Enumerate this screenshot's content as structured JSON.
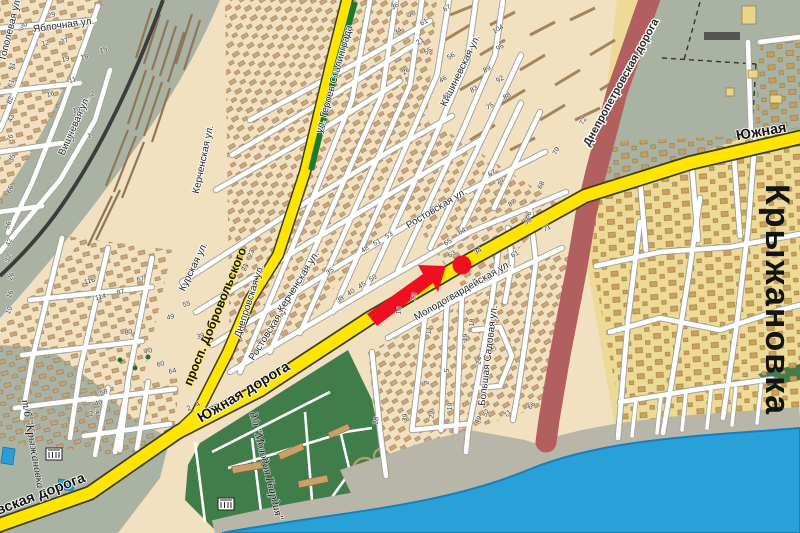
{
  "map": {
    "palette": {
      "land_west": "#f2e1c0",
      "land_east": "#ecda96",
      "rail_zone": "#aab3a3",
      "park_green": "#417c4b",
      "median_green": "#1f7a2d",
      "water_blue": "#2aa0d8",
      "beach_gray": "#b8b5a9",
      "road_yellow": "#ffe500",
      "road_red": "#b25f5f",
      "street_white": "#ffffff",
      "marker_red": "#ee1020",
      "building_tan": "#c9a478"
    },
    "marker": {
      "dot_x": 462,
      "dot_y": 265,
      "dot_r": 9.5,
      "arrow_tail_x": 372,
      "arrow_tail_y": 320,
      "arrow_tip_x": 446,
      "arrow_tip_y": 266
    },
    "street_labels": [
      {
        "t": "Южная дорога",
        "x": 246,
        "y": 396,
        "r": -31,
        "c": "road-lg"
      },
      {
        "t": "Южная",
        "x": 762,
        "y": 136,
        "r": -10,
        "c": "road-lg"
      },
      {
        "t": "Николаевская дорога",
        "x": 14,
        "y": 509,
        "r": -21,
        "c": "road-lg"
      },
      {
        "t": "просп. Добровольского",
        "x": 219,
        "y": 318,
        "r": -68,
        "c": "road"
      },
      {
        "t": "ул. Героев Сталинграда",
        "x": 337,
        "y": 80,
        "r": -74,
        "c": "street"
      },
      {
        "t": "Днепропетровская дорога",
        "x": 624,
        "y": 84,
        "r": -61,
        "c": "halo"
      },
      {
        "t": "Ростовская ул.",
        "x": 438,
        "y": 211,
        "r": -31,
        "c": "street"
      },
      {
        "t": "Ростовская ул.",
        "x": 272,
        "y": 332,
        "r": -58,
        "c": "street"
      },
      {
        "t": "Керченская ул.",
        "x": 301,
        "y": 283,
        "r": -58,
        "c": "street"
      },
      {
        "t": "Керченская ул.",
        "x": 206,
        "y": 160,
        "r": -78,
        "c": "street"
      },
      {
        "t": "Днепровская ул.",
        "x": 252,
        "y": 302,
        "r": -72,
        "c": "street"
      },
      {
        "t": "Курская ул.",
        "x": 196,
        "y": 268,
        "r": -64,
        "c": "street"
      },
      {
        "t": "Кишиневская ул.",
        "x": 463,
        "y": 72,
        "r": -64,
        "c": "street"
      },
      {
        "t": "Молодогвардейская ул.",
        "x": 464,
        "y": 293,
        "r": -30,
        "c": "street"
      },
      {
        "t": "Большая Садовая ул.",
        "x": 491,
        "y": 356,
        "r": -83,
        "c": "street"
      },
      {
        "t": "Вишневая ул.",
        "x": 77,
        "y": 127,
        "r": -66,
        "c": "street"
      },
      {
        "t": "Яблочная ул.",
        "x": 64,
        "y": 28,
        "r": -8,
        "c": "street"
      },
      {
        "t": "Тополевая ул.",
        "x": 13,
        "y": 30,
        "r": -76,
        "c": "street"
      },
      {
        "t": "Крыжановка",
        "x": 766,
        "y": 300,
        "r": 90,
        "c": "place-big"
      },
      {
        "t": "т/б \"Крыжановка\"",
        "x": 30,
        "y": 447,
        "r": 80,
        "c": "place-italic"
      },
      {
        "t": "д/л \"Молодая Гвардия\"",
        "x": 263,
        "y": 467,
        "r": 76,
        "c": "place-italic"
      }
    ],
    "house_numbers": [
      [
        "29",
        52,
        17,
        -15
      ],
      [
        "30",
        24,
        27,
        -15
      ],
      [
        "12",
        46,
        45,
        -15
      ],
      [
        "27",
        65,
        43,
        -15
      ],
      [
        "19",
        66,
        61,
        -15
      ],
      [
        "18",
        85,
        59,
        -15
      ],
      [
        "15",
        104,
        52,
        -15
      ],
      [
        "11",
        73,
        82,
        -15
      ],
      [
        "16",
        51,
        96,
        -15
      ],
      [
        "2",
        93,
        96,
        -15
      ],
      [
        "10",
        77,
        112,
        -15
      ],
      [
        "7",
        74,
        142,
        -15
      ],
      [
        "1",
        90,
        138,
        -15
      ],
      [
        "51",
        14,
        67,
        -70
      ],
      [
        "61",
        13,
        84,
        -70
      ],
      [
        "82",
        12,
        101,
        -70
      ],
      [
        "43",
        13,
        119,
        -70
      ],
      [
        "76",
        12,
        139,
        -70
      ],
      [
        "35",
        14,
        159,
        -70
      ],
      [
        "66",
        12,
        190,
        -70
      ],
      [
        "56",
        10,
        226,
        -70
      ],
      [
        "42",
        11,
        243,
        -70
      ],
      [
        "32",
        10,
        259,
        -70
      ],
      [
        "26",
        13,
        277,
        -70
      ],
      [
        "16",
        12,
        295,
        -70
      ],
      [
        "10",
        11,
        311,
        -70
      ],
      [
        "116",
        90,
        283,
        -14
      ],
      [
        "114",
        101,
        299,
        -14
      ],
      [
        "87",
        121,
        294,
        -14
      ],
      [
        "67",
        141,
        281,
        -14
      ],
      [
        "80",
        129,
        334,
        -14
      ],
      [
        "49",
        171,
        319,
        -14
      ],
      [
        "55",
        187,
        306,
        -14
      ],
      [
        "39",
        201,
        338,
        -14
      ],
      [
        "70",
        149,
        353,
        -14
      ],
      [
        "64",
        173,
        373,
        -14
      ],
      [
        "60",
        161,
        366,
        -14
      ],
      [
        "58",
        104,
        394,
        -14
      ],
      [
        "40",
        99,
        405,
        -14
      ],
      [
        "2-й",
        95,
        415,
        -14
      ],
      [
        "36",
        396,
        8,
        -30
      ],
      [
        "70",
        413,
        16,
        -30
      ],
      [
        "61",
        425,
        24,
        -30
      ],
      [
        "67",
        448,
        10,
        -30
      ],
      [
        "34",
        399,
        33,
        -30
      ],
      [
        "21",
        421,
        43,
        -30
      ],
      [
        "55",
        429,
        53,
        -30
      ],
      [
        "26",
        407,
        73,
        -30
      ],
      [
        "56",
        452,
        58,
        -30
      ],
      [
        "46",
        444,
        81,
        -30
      ],
      [
        "89",
        488,
        71,
        -30
      ],
      [
        "83",
        475,
        91,
        -30
      ],
      [
        "95",
        501,
        49,
        -30
      ],
      [
        "104",
        499,
        31,
        -30
      ],
      [
        "92",
        501,
        81,
        -30
      ],
      [
        "88",
        508,
        98,
        -30
      ],
      [
        "75",
        491,
        108,
        -30
      ],
      [
        "42",
        447,
        98,
        -30
      ],
      [
        "72",
        585,
        122,
        -62
      ],
      [
        "70",
        558,
        152,
        -62
      ],
      [
        "68",
        543,
        186,
        -62
      ],
      [
        "66",
        530,
        216,
        -62
      ],
      [
        "38",
        341,
        301,
        -31
      ],
      [
        "40",
        352,
        294,
        -31
      ],
      [
        "45",
        363,
        287,
        -31
      ],
      [
        "50",
        374,
        280,
        -31
      ],
      [
        "35",
        331,
        273,
        -31
      ],
      [
        "48",
        366,
        251,
        -31
      ],
      [
        "51",
        378,
        244,
        -31
      ],
      [
        "53",
        390,
        237,
        -31
      ],
      [
        "65",
        449,
        244,
        -31
      ],
      [
        "64",
        463,
        233,
        -31
      ],
      [
        "63",
        453,
        256,
        -31
      ],
      [
        "34",
        479,
        253,
        -31
      ],
      [
        "61",
        516,
        256,
        -31
      ],
      [
        "50",
        529,
        223,
        -31
      ],
      [
        "71",
        548,
        230,
        -31
      ],
      [
        "67",
        493,
        175,
        -31
      ],
      [
        "70",
        501,
        183,
        -31
      ],
      [
        "87",
        513,
        205,
        -31
      ],
      [
        "23",
        416,
        297,
        -80
      ],
      [
        "16",
        401,
        311,
        -80
      ],
      [
        "11",
        431,
        331,
        -80
      ],
      [
        "18",
        474,
        323,
        -80
      ],
      [
        "19",
        467,
        338,
        -80
      ],
      [
        "24",
        481,
        361,
        -80
      ],
      [
        "5",
        449,
        371,
        -80
      ],
      [
        "2",
        429,
        383,
        -80
      ],
      [
        "28",
        378,
        421,
        -80
      ],
      [
        "39",
        407,
        418,
        -80
      ],
      [
        "22",
        434,
        415,
        -80
      ],
      [
        "19",
        452,
        407,
        -80
      ],
      [
        "49",
        480,
        421,
        -60
      ],
      [
        "52",
        488,
        414,
        -60
      ],
      [
        "71",
        509,
        415,
        -45
      ],
      [
        "66",
        533,
        407,
        -45
      ],
      [
        "2",
        190,
        410,
        -30
      ],
      [
        "4",
        199,
        406,
        -30
      ],
      [
        "21",
        247,
        268,
        -68
      ],
      [
        "23",
        253,
        254,
        -68
      ]
    ]
  }
}
